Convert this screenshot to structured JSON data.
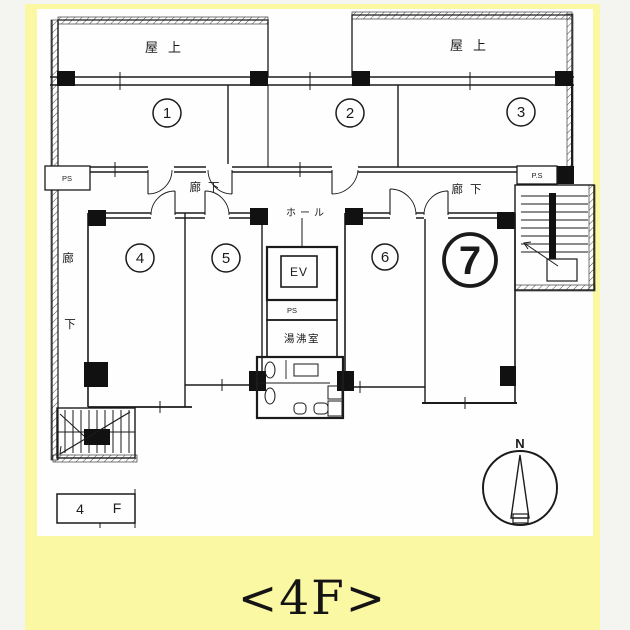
{
  "caption": {
    "text": "<4F>"
  },
  "plan": {
    "roof_left_label": "屋上",
    "roof_right_label": "屋上",
    "corridor_top_label": "廊下",
    "corridor_right_label": "廊下",
    "corridor_left_char_top": "廊",
    "corridor_left_char_bottom": "下",
    "hall_label": "ホール",
    "elevator_label": "EV",
    "pipe_space_top_left": "PS",
    "pipe_space_right": "P.S",
    "pipe_space_center": "PS",
    "kitchenette_label": "湯沸室",
    "floor_box": {
      "number": "4",
      "letter": "F"
    },
    "compass_north": "N",
    "rooms": [
      {
        "number": "1",
        "highlighted": false
      },
      {
        "number": "2",
        "highlighted": false
      },
      {
        "number": "3",
        "highlighted": false
      },
      {
        "number": "4",
        "highlighted": false
      },
      {
        "number": "5",
        "highlighted": false
      },
      {
        "number": "6",
        "highlighted": false
      },
      {
        "number": "7",
        "highlighted": true
      }
    ]
  },
  "colors": {
    "panel_yellow": "#FBF8A3",
    "page_margin": "#f4f4f1",
    "line": "#1b1b1b",
    "sheet_white": "#fefefe"
  }
}
